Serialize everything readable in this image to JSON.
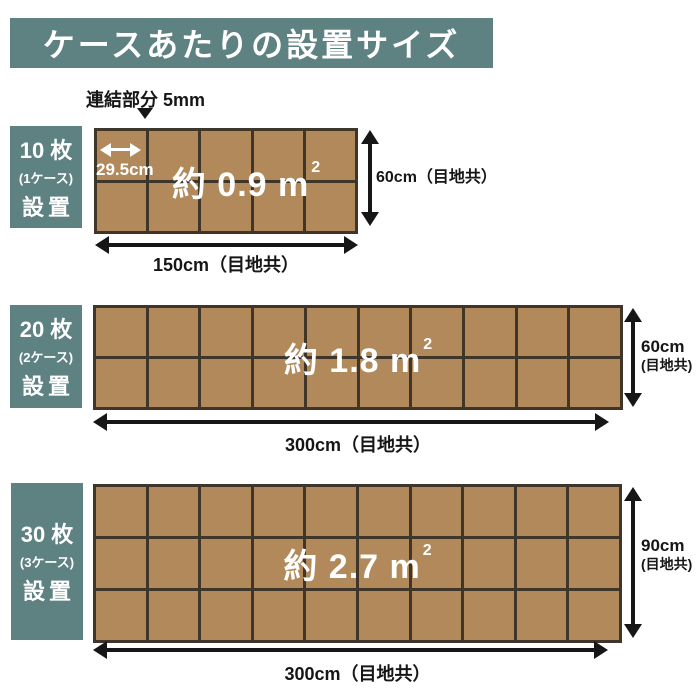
{
  "title": "ケースあたりの設置サイズ",
  "annotation": {
    "joint_label": "連結部分 5mm",
    "tile_width_label": "29.5cm"
  },
  "colors": {
    "teal": "#5e8182",
    "tile": "#b2895b",
    "line": "#3f3529",
    "ink": "#161616"
  },
  "sections": [
    {
      "count_label": "10 枚",
      "case_label": "(1ケース)",
      "action_label": "設置",
      "area_label": "約 0.9 m",
      "area_sup": "2",
      "grid": {
        "cols": 5,
        "rows": 2
      },
      "width_label": "150cm（目地共）",
      "height_label": "60cm（目地共）"
    },
    {
      "count_label": "20 枚",
      "case_label": "(2ケース)",
      "action_label": "設置",
      "area_label": "約 1.8 m",
      "area_sup": "2",
      "grid": {
        "cols": 10,
        "rows": 2
      },
      "width_label": "300cm（目地共）",
      "height_label_line1": "60cm",
      "height_label_line2": "(目地共)"
    },
    {
      "count_label": "30 枚",
      "case_label": "(3ケース)",
      "action_label": "設置",
      "area_label": "約 2.7 m",
      "area_sup": "2",
      "grid": {
        "cols": 10,
        "rows": 3
      },
      "width_label": "300cm（目地共）",
      "height_label_line1": "90cm",
      "height_label_line2": "(目地共)"
    }
  ]
}
